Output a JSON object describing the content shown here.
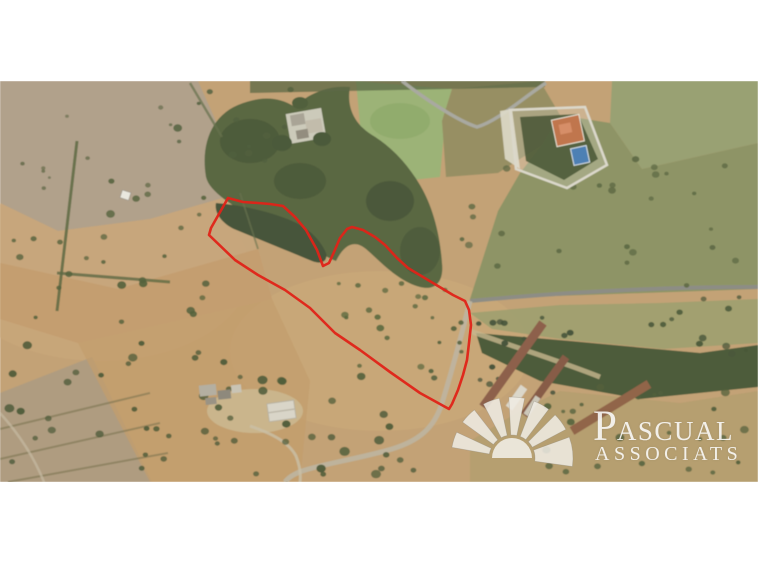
{
  "window": {
    "width": 758,
    "height": 564
  },
  "photo": {
    "description": "Aerial satellite photograph of rural farmland with scattered trees, farm buildings, tracks and a red land-plot outline"
  },
  "boundary": {
    "label": "plot-boundary-outline",
    "color": "#e02318"
  },
  "watermark": {
    "initial": "P",
    "name_rest": "ASCUAL",
    "line2": "ASSOCIATS",
    "text_color": "rgba(255,255,255,0.85)",
    "fan_fill": "#efece3"
  },
  "palette": {
    "margin_white": "#ffffff",
    "field_tan": "#c3a276",
    "field_gray": "#b1a18b",
    "woods_green": "#5a6743",
    "grass_green": "#9cb377",
    "road_gray": "#8d8d85",
    "track_sand": "#beb5a1",
    "warehouse_rust": "#8d604b",
    "house_roof_orange": "#c0764d",
    "pool_blue": "#4d80b4"
  }
}
